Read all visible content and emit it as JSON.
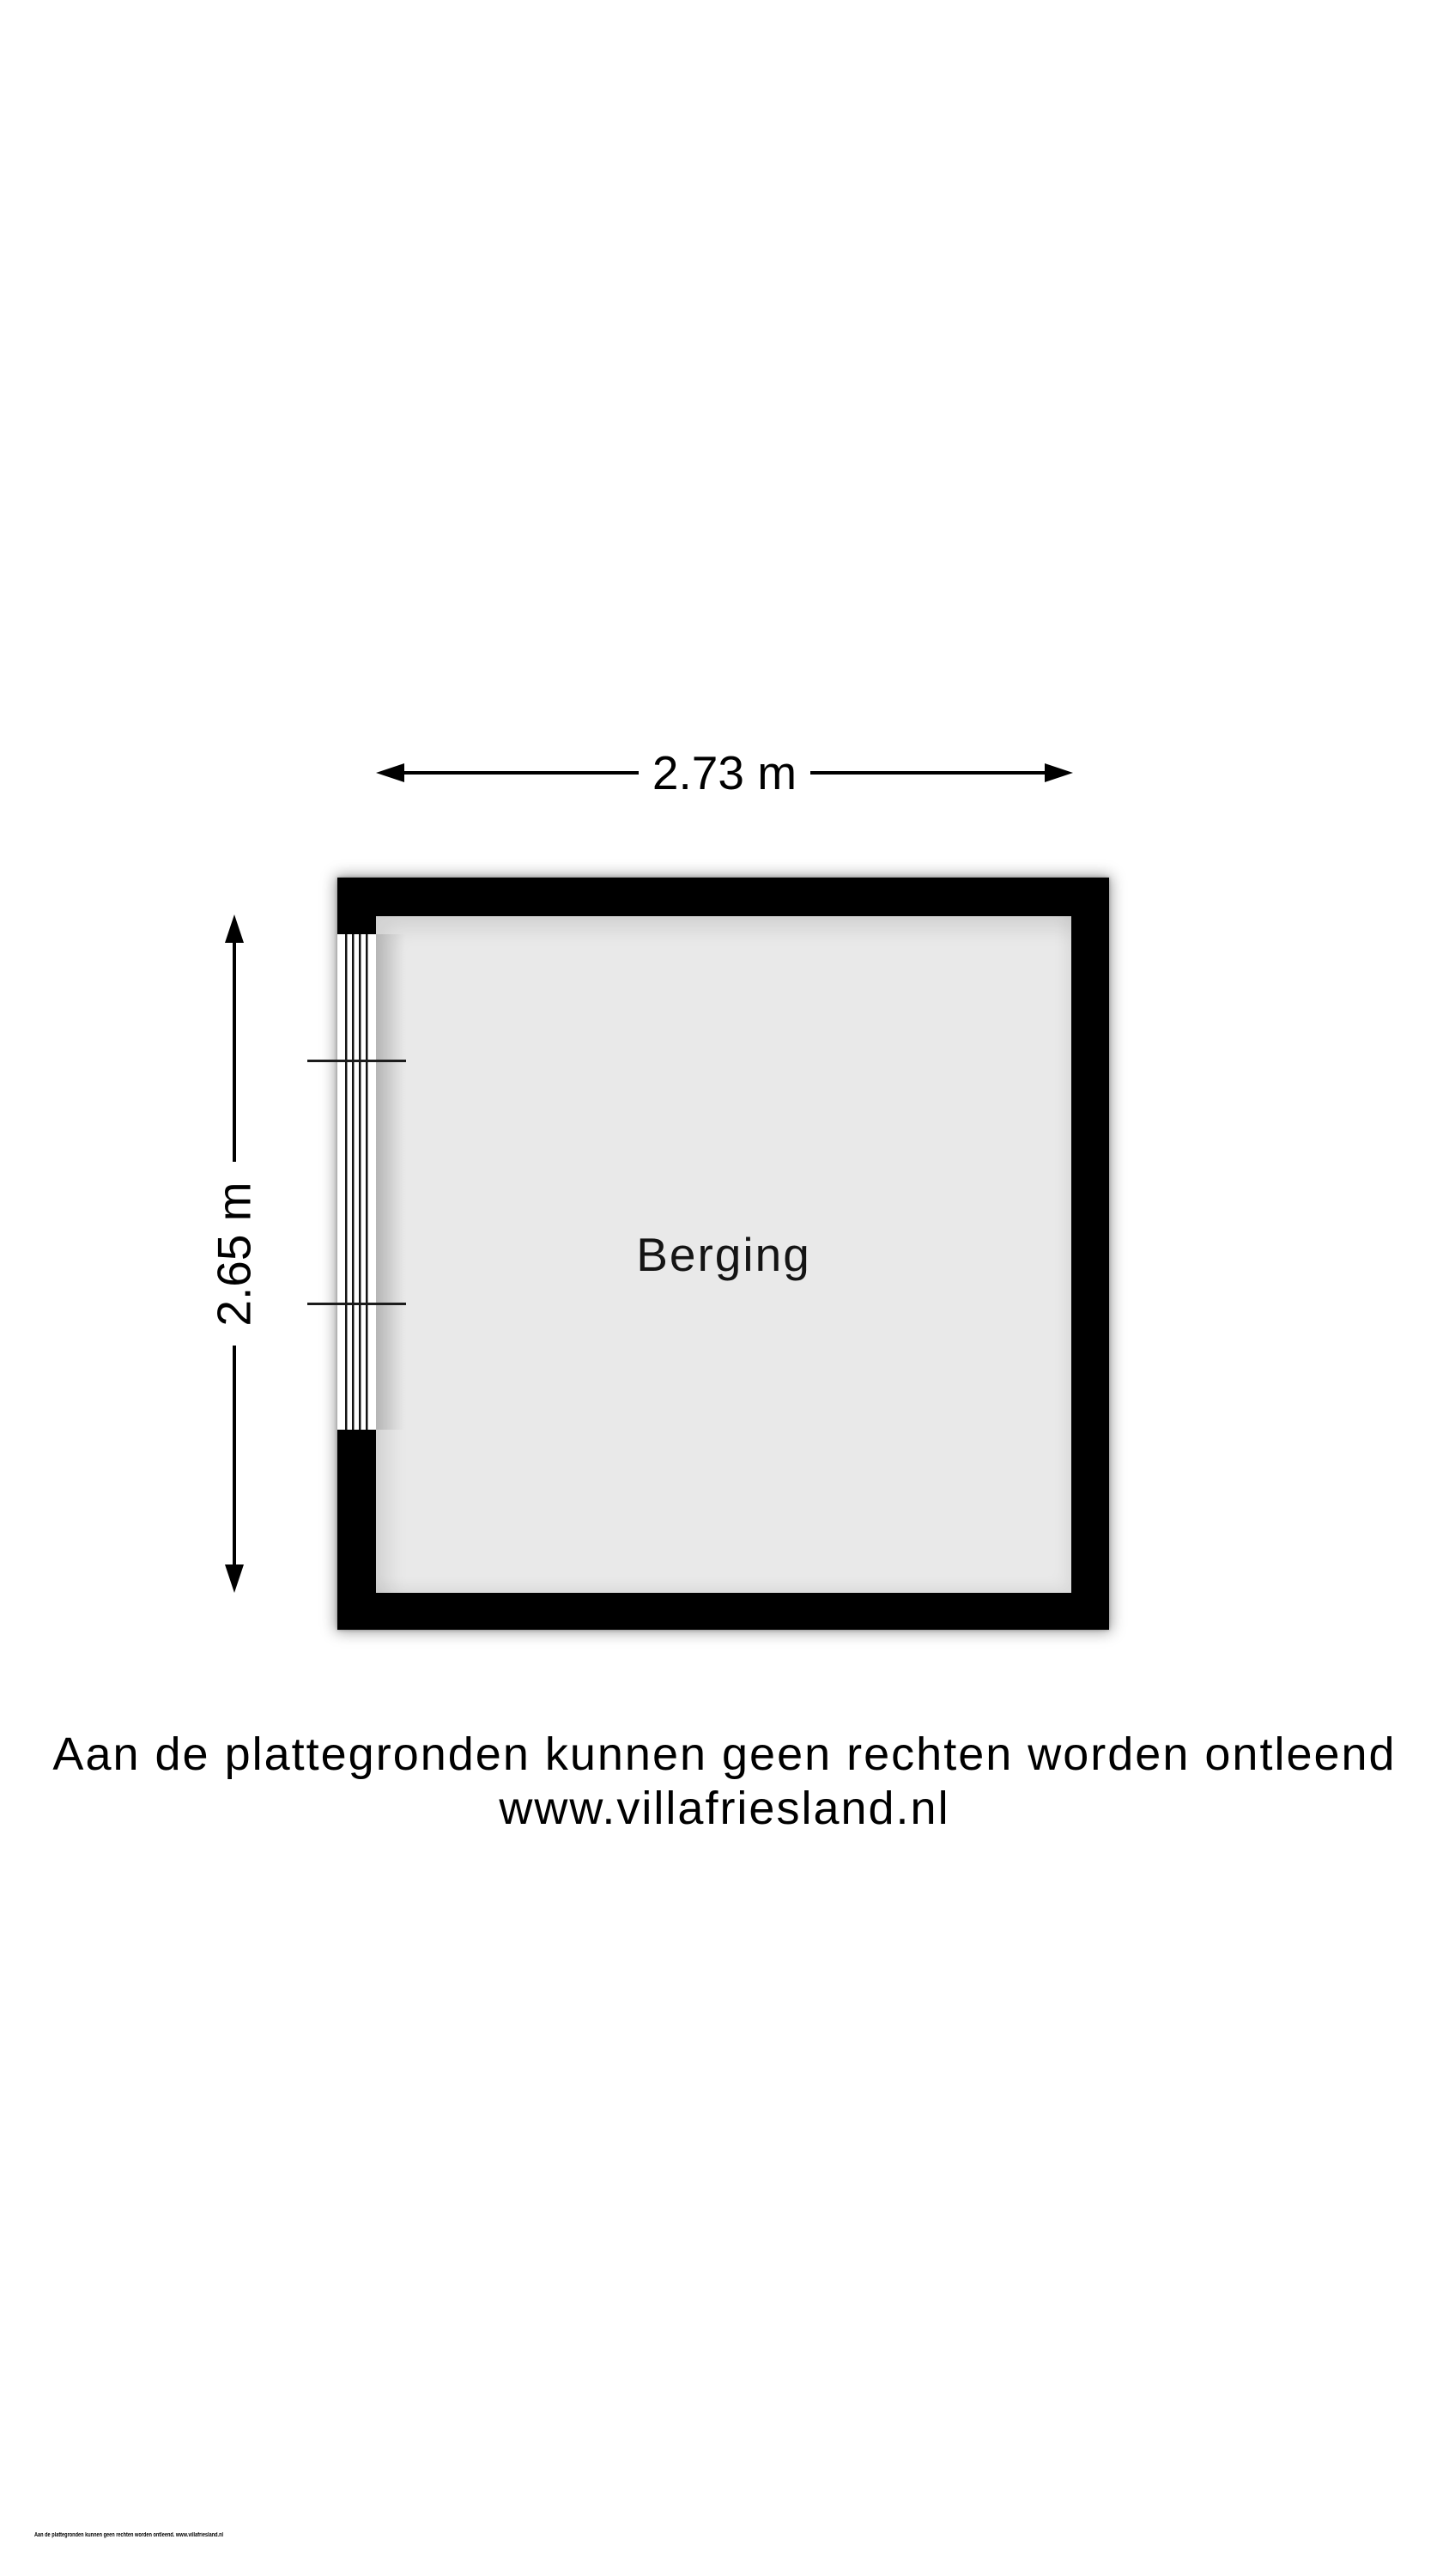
{
  "colors": {
    "wall": "#000000",
    "interior": "#e9e9e9",
    "window": "#ffffff"
  },
  "floorplan": {
    "room": {
      "label": "Berging",
      "width_dimension": "2.73 m",
      "height_dimension": "2.65 m"
    }
  },
  "disclaimer": {
    "line1": "Aan de plattegronden kunnen geen rechten worden ontleend",
    "line2": "www.villafriesland.nl"
  },
  "footer": {
    "text": "Aan de plattegronden kunnen geen rechten worden ontleend. www.villafriesland.nl"
  }
}
